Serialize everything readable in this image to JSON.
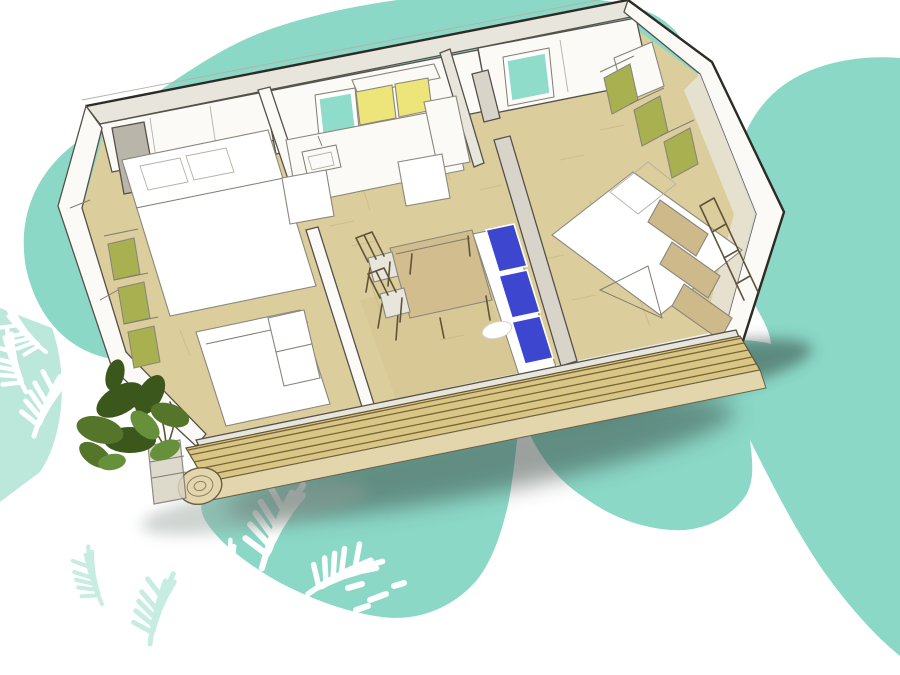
{
  "scene": {
    "title": "mobile-home-isometric-cutaway-watercolor-illustration",
    "background": "#FFFFFF",
    "palette": {
      "teal": "#8BD8C7",
      "teal_light": "#B5E6D8",
      "floor": "#DCCD9C",
      "floor_shade": "#C4B27C",
      "deck": "#D9C684",
      "deck_face": "#E3D6AC",
      "deck_line": "#77643A",
      "wall_fill": "#FBFAF6",
      "wall_shade": "#E8E5DC",
      "partition_gray": "#D8D4CA",
      "closet_gray": "#B9B5AA",
      "cabinet_yellow": "#EDE47A",
      "panel_olive": "#A9B050",
      "cushion_blue": "#3D46CE",
      "window_teal": "#8FDCCB",
      "table_wood": "#D2BD8E",
      "bunk_wood": "#CDB98A",
      "bed_white": "#FFFFFF",
      "pot_glass": "#D8D4C4",
      "plant_dark": "#3C571C",
      "plant_mid": "#55752A",
      "plant_light": "#67903A",
      "shadow_dark": "#37443F",
      "shadow_core": "#2F3D38",
      "shadow_soft": "#93A09A",
      "palm_white": "#FFFFFF"
    },
    "rooms": [
      {
        "name": "bedroom-left",
        "furniture": [
          "double-bed",
          "single-bed-with-steps",
          "wardrobe-olive-panels",
          "closet-wall"
        ]
      },
      {
        "name": "kitchen-living",
        "furniture": [
          "teal-window",
          "yellow-upper-cabinets",
          "kitchen-counter-with-sink",
          "tall-cabinet",
          "low-units",
          "dining-table",
          "two-chairs",
          "sofa-with-three-blue-cushions"
        ]
      },
      {
        "name": "bedroom-right",
        "furniture": [
          "double-bed",
          "olive-shelf-panels",
          "wood-bunk-ladder",
          "teal-window",
          "corner-cabinet"
        ]
      }
    ],
    "exterior": [
      "wood-deck-terrace-with-log-edge",
      "potted-plant",
      "white-palm-frond-silhouettes",
      "teal-watercolor-blobs",
      "soft-ground-shadow"
    ]
  }
}
